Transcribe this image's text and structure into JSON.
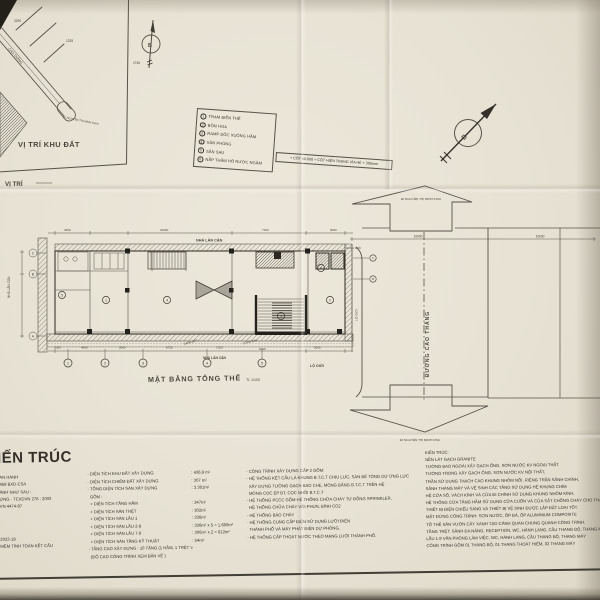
{
  "site_map": {
    "title": "VỊ TRÍ KHU ĐẤT",
    "caption": "VỊ TRÍ",
    "road_name": "CAO THẮNG",
    "street_note": "ĐI NGUYỄN THỊ MINH KHAI",
    "dims": [
      "3290",
      "1235",
      "2746"
    ]
  },
  "compass": {
    "north": "B"
  },
  "legend": {
    "items": [
      {
        "n": "1",
        "label": "TRẠM BIẾN THẾ"
      },
      {
        "n": "2",
        "label": "BỒN HOA"
      },
      {
        "n": "3",
        "label": "RAMP DỐC XUỐNG HẦM"
      },
      {
        "n": "4",
        "label": "VĂN PHÒNG"
      },
      {
        "n": "5",
        "label": "SÂN SAU"
      },
      {
        "n": "6",
        "label": "NẮP THĂM HỐ NƯỚC NGẦM"
      }
    ]
  },
  "note": {
    "text": "+ CỐT ±0.000 = CỐT HIỆN TRẠNG VỈA HÈ + 300mm"
  },
  "plan": {
    "title": "MẶT BẰNG TỔNG THỂ",
    "scale": "TL 1/100",
    "neighbor_top": "NHÀ LÂN CẬN",
    "neighbor_left": "NHÀ LÂN CẬN",
    "neighbor_bottom": "NHÀ LÂN CẬN",
    "boundary_label": "RANH ĐẤT",
    "back_gate_label": "CỔNG SAU",
    "setback_label": "LỘ GIỚI",
    "dims_top": [
      "3450",
      "24000",
      "7100",
      "6000"
    ],
    "dims_bottom": [
      "2080",
      "4600",
      "5000",
      "8730",
      "7100",
      "6000",
      "5000"
    ],
    "grid_cols": [
      "1",
      "2",
      "3",
      "4",
      "5"
    ],
    "grid_rows": [
      "C",
      "B",
      "A"
    ],
    "keys": [
      "1",
      "2",
      "3",
      "4",
      "5",
      "6"
    ]
  },
  "road": {
    "name": "ĐƯỜNG CAO THẮNG",
    "to_top": "ĐI NGUYỄN THỊ MINH KHAI",
    "to_bottom": "ĐI NGUYỄN THỊ MINH KHAI",
    "dims": [
      "10000",
      "10000"
    ],
    "boundary_label": "RANH GIỚI",
    "markers": [
      "C",
      "B"
    ]
  },
  "notes": {
    "heading": "IẾN TRÚC",
    "left_col": [
      "AN HÀNH",
      "459 BXD-CSA",
      "ÀNH NHƯ SAU :",
      "ỰNG - TCXDVN 276 : 2003",
      "VN 4474-87"
    ],
    "left_col2": [
      "2023-19",
      "MỀM TÍNH TOÁN KẾT CẤU"
    ],
    "stats": [
      {
        "label": "- DIỆN TÍCH KHU ĐẤT XÂY DỰNG",
        "value": ": 436,9 m²"
      },
      {
        "label": "- DIỆN TÍCH CHIẾM ĐẤT XÂY DỰNG",
        "value": ": 307 m²"
      },
      {
        "label": "- TỔNG DIỆN TÍCH SÀN XÂY DỰNG",
        "value": ": 3.381m²"
      },
      {
        "label": "  GỒM :",
        "value": ""
      },
      {
        "label": "  + DIỆN TÍCH TẦNG HẦM",
        "value": ": 347m²"
      },
      {
        "label": "  + DIỆN TÍCH SÀN TRỆT",
        "value": ": 302m²"
      },
      {
        "label": "  + DIỆN TÍCH SÀN LẦU 1",
        "value": ": 336m²"
      },
      {
        "label": "  + DIỆN TÍCH SÀN LẦU 2-6",
        "value": ": 336m² x 5 = 1.680m²"
      },
      {
        "label": "  + DIỆN TÍCH SÀN LẦU 7-8",
        "value": ": 306m² x 2 = 612m²"
      },
      {
        "label": "  + DIỆN TÍCH SÀN TẦNG KỸ THUẬT",
        "value": ": 54m²"
      },
      {
        "label": "- TẦNG CAO XÂY DỰNG : 10 TẦNG (1 HẦM, 1 TRỆT VÀ 8 LẦU)",
        "value": ""
      },
      {
        "label": "  (ĐỘ CAO CÔNG TRÌNH XEM BẢN VẼ )",
        "value": ""
      }
    ],
    "systems": [
      "- CÔNG TRÌNH XÂY DỰNG CẤP 2 GỒM:",
      "- HỆ THỐNG KẾT CẤU LÀ KHUNG B.T.C.T CHỊU LỰC, SÀN BÊ TÔNG DỰ ỨNG LỰC",
      "  XÂY DỰNG TƯỜNG GẠCH BAO CHE, MÓNG BĂNG B.T.C.T TRÊN HỆ",
      "  MÓNG CỌC ÉP BT, CỌC NHỒI B.T.C.T",
      "- HỆ THỐNG PCCC GỒM HỆ THỐNG CHỮA CHÁY TỰ ĐỘNG SPRINKLER,",
      "  HỆ THỐNG CHỮA CHÁY VÒI PHUN, BÌNH CO2",
      "- HỆ THỐNG BÁO CHÁY",
      "- HỆ THỐNG CUNG CẤP ĐIỆN SỬ DỤNG LƯỚI ĐIỆN",
      "  THÀNH PHỐ VÀ MÁY PHÁT ĐIỆN DỰ PHÒNG.",
      "- HỆ THỐNG CẤP THOÁT NƯỚC THEO MẠNG LƯỚI THÀNH PHỐ."
    ],
    "finishes": [
      "KIẾN TRÚC:",
      "NỀN LÁT GẠCH GRANITE",
      "TƯỜNG BAO NGOÀI XÂY GẠCH ỐNG, SƠN NƯỚC KV NGOẠI THẤT",
      "TƯỜNG TRONG XÂY GẠCH ỐNG, SƠN NƯỚC KV NỘI THẤT,",
      "TRẦN SỬ DỤNG THẠCH CAO KHUNG NHÔM NỔI, RIÊNG TRẦN SẢNH CHÍNH,",
      "SẢNH THANG MÁY VÀ VỆ SINH CÁC TẦNG SỬ DỤNG HỆ KHUNG CHÌM",
      "HỆ CỬA SỔ, VÁCH KÍNH VÀ CỬA ĐI CHÍNH SỬ DỤNG KHUNG NHÔM KÍNH,",
      "HỆ THỐNG CỬA TẦNG HẦM SỬ DỤNG CỬA CUỐN VÀ CỬA SẮT CHỐNG CHÁY CHO THANG BỘ",
      "THIẾT BỊ ĐIỆN CHIẾU SÁNG VÀ THIẾT BỊ VỆ SINH ĐƯỢC LẮP ĐẶT LOẠI TỐT.",
      "MẶT ĐỨNG CÔNG TRÌNH: SƠN NƯỚC, ỐP ĐÁ, ỐP ALUMINIUM COMPOSITE",
      "TỔ THỂ SÂN VƯỜN CÂY XANH TẠO CẢNH QUAN CHUNG QUANH CÔNG TRÌNH.",
      "TẦNG TRỆT: SẢNH ĐA NĂNG, RECEPTION, WC, HÀNH LANG, CẦU THANG BỘ, THANG MÁY",
      "LẦU 1-8 VĂN PHÒNG LÀM VIỆC, WC, HÀNH LANG, CẦU THANG BỘ, THANG MÁY",
      "CÔNG TRÌNH GỒM 01 THANG BỘ, 01 THANG THOÁT HIỂM, 02 THANG MÁY"
    ]
  }
}
